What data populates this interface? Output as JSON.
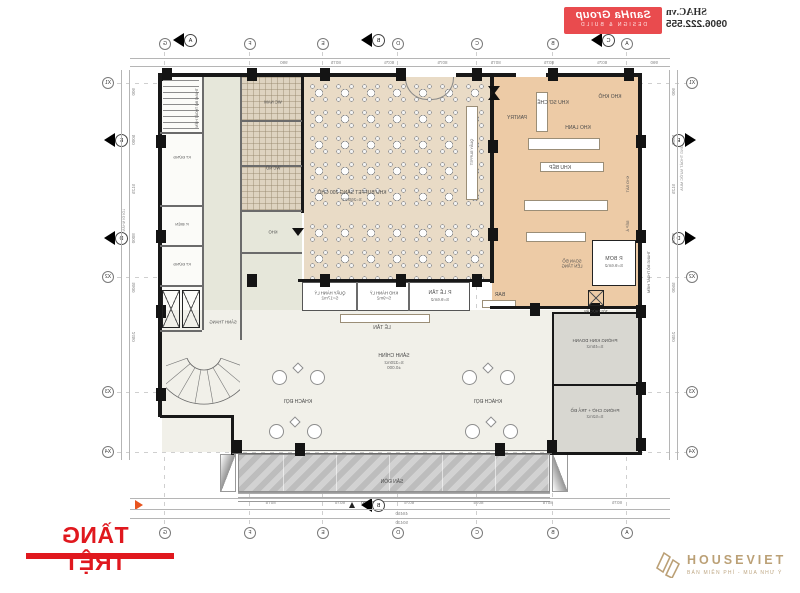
{
  "title": "TẦNG TRỆT",
  "watermark_shac": {
    "brand": "SanHa Group",
    "brand_tagline": "DESIGN & BUILD",
    "website": "SHAC.vn",
    "phone": "0906.222.555"
  },
  "watermark_houseviet": {
    "name": "HOUSEVIET",
    "tagline": "BÁN MIỄN PHÍ - MUA NHƯ Ý"
  },
  "grid": {
    "cols": [
      "A",
      "B",
      "C",
      "D",
      "E",
      "F",
      "G"
    ],
    "rows": [
      "X1",
      "X2",
      "X3",
      "X4"
    ],
    "sections": {
      "a": "A",
      "b": "B",
      "c": "C",
      "d": "D",
      "e": "E"
    }
  },
  "dims": {
    "top_row": [
      "990",
      "8075",
      "8075",
      "8075",
      "8075",
      "8075",
      "8075",
      "990"
    ],
    "bottom_bays": [
      "8075",
      "8075",
      "8075",
      "8075",
      "8075",
      "8075"
    ],
    "bottom_subtotal": "48450",
    "bottom_total": "50430",
    "left_rows": [
      "900",
      "5000",
      "5125",
      "8000",
      "5500",
      "2450"
    ],
    "right_rows": [
      "900",
      "5000",
      "5125",
      "8000",
      "5500",
      "2450"
    ],
    "level_zero": "±0.000"
  },
  "rooms": {
    "banquet_l1": "KHU BUFFET SÁNG 200 CHỖ",
    "banquet_l2": "S=260m2",
    "buffet_counter": "QUẦY BUFFET",
    "kho_kho": "KHO KHÔ",
    "so_che": "KHU SƠ CHẾ",
    "pantry": "PANTRY",
    "kho_lanh": "KHO LẠNH",
    "khu_bep": "KHU BẾP",
    "bep_a": "BẾP Á",
    "kho_bat": "KHO BÁT",
    "p_le_tan_l1": "P. LỄ TÂN",
    "p_le_tan_l2": "S=9.6m2",
    "kho_hanh_ly_l1": "KHO HÀNH LÝ",
    "kho_hanh_ly_l2": "S=9m2",
    "quay_hanh_ly_l1": "QUẦY HÀNH LÝ",
    "quay_hanh_ly_l2": "S=17m2",
    "le_tan": "LỄ TÂN",
    "bar": "BAR",
    "sanh_chinh_l1": "SẢNH CHÍNH",
    "sanh_chinh_l2": "S=320m2",
    "sanh_chinh_l3": "±0.000",
    "khach_doi": "KHÁCH ĐỢI",
    "san_don": "SÂN ĐÓN",
    "kinh_doanh_l1": "PHÒNG KINH DOANH",
    "kinh_doanh_l2": "S=45m2",
    "phong_cho_l1": "PHÒNG CHỜ + TRẢ ĐỒ",
    "phong_cho_l2": "S=52m2",
    "p_bom_l1": "P. BƠM",
    "p_bom_l2": "S=9.6m2",
    "soan_do": "SOẠN ĐỒ LÊN TẦNG",
    "sanh_thang": "SẢNH THANG",
    "wc_nam": "WC NAM",
    "wc_nu": "WC NỮ",
    "p_dien": "P. ĐIỆN",
    "kt_dung": "KT ĐỨNG",
    "kho": "KHO",
    "thoat_hiem": "THANG BỘ THOÁT HIỂM",
    "ong_thoat": "ỐNG THOÁT NƯỚC MƯA",
    "loi_di_nv": "LỐI ĐI NHÂN VIÊN",
    "thang_toi": "TỜI THỨC ĂN"
  }
}
